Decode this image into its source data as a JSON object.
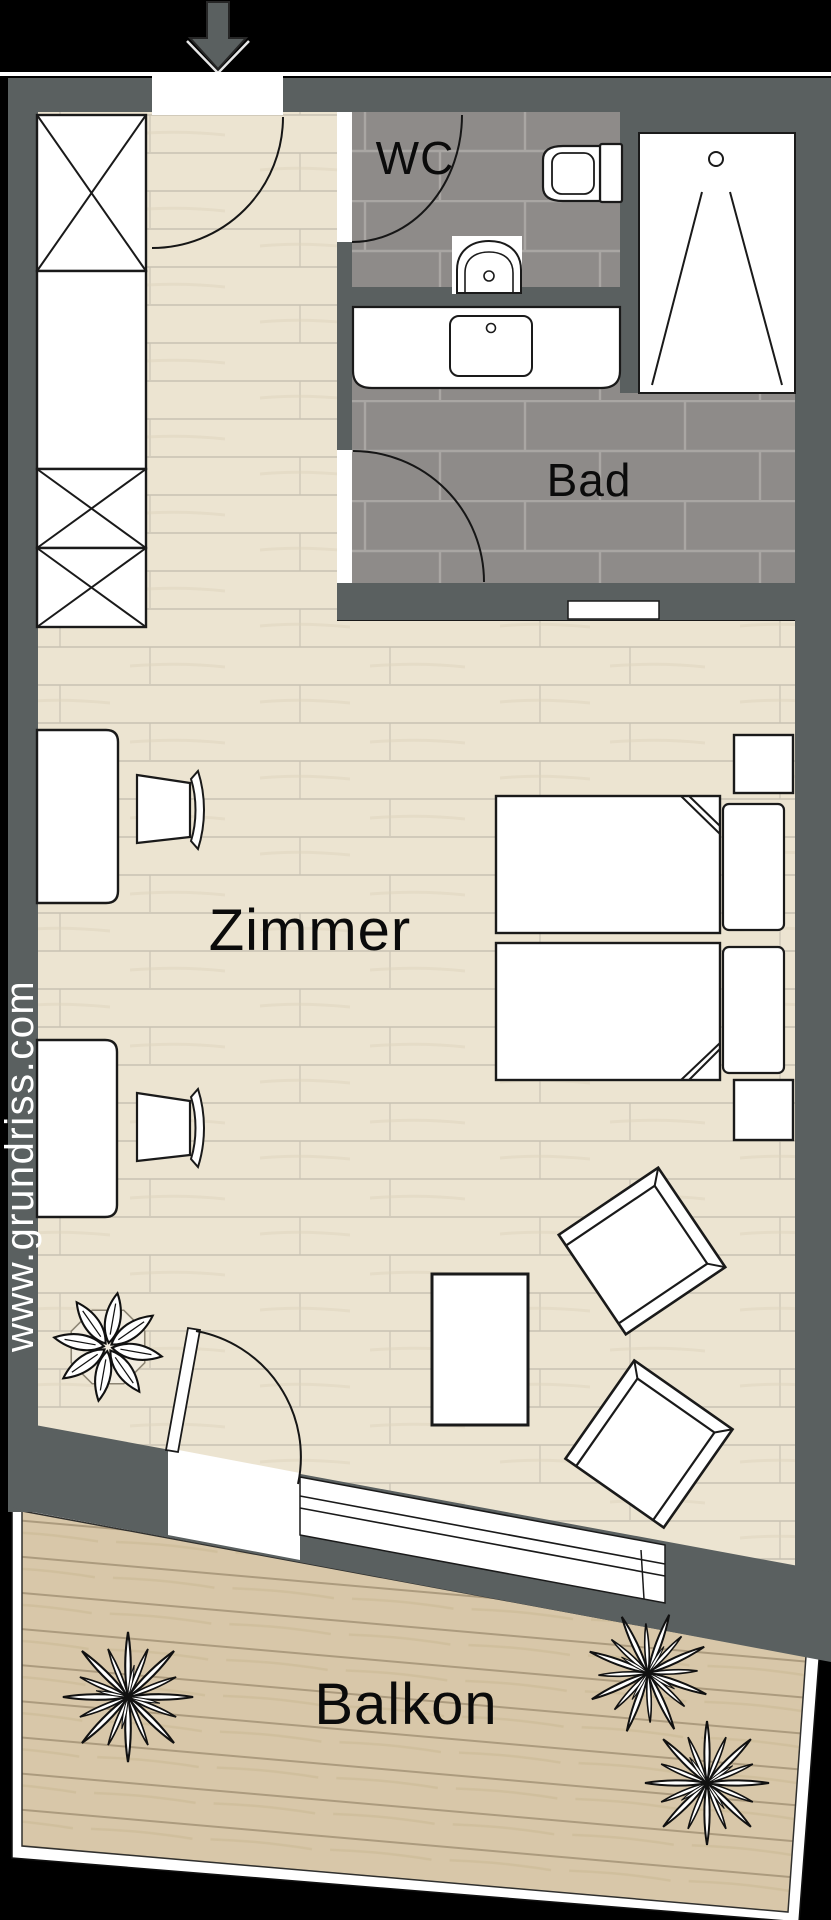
{
  "floorplan": {
    "rooms": {
      "wc": {
        "label": "WC"
      },
      "bad": {
        "label": "Bad"
      },
      "zimmer": {
        "label": "Zimmer"
      },
      "balkon": {
        "label": "Balkon"
      }
    },
    "watermark": "www.grundriss.com",
    "colors": {
      "background": "#000000",
      "wall": "#5a6060",
      "wood_floor": "#ece4d1",
      "bath_tile": "#8e8b89",
      "balcony_deck": "#d8c7a9",
      "furniture_fill": "#ffffff",
      "outline": "#1a1a1a"
    },
    "elements": [
      "entrance-arrow",
      "entrance-door",
      "wardrobe",
      "wc-door",
      "wc-toilet",
      "wc-sink",
      "shower",
      "vanity-sink",
      "bath-door",
      "wall-niche",
      "twin-beds",
      "nightstands",
      "desks",
      "desk-chairs",
      "coffee-table",
      "armchairs",
      "balcony-door",
      "balcony-window",
      "plants",
      "balcony-railing"
    ]
  }
}
